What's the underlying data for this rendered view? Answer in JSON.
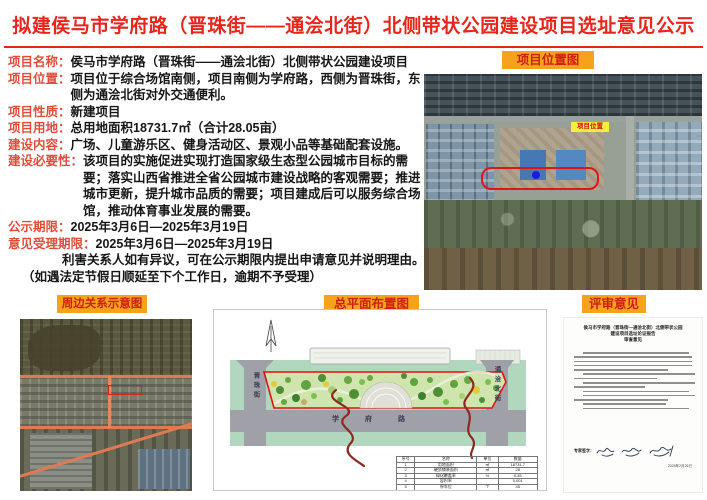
{
  "title": "拟建侯马市学府路（晋珠街——通浍北街）北侧带状公园建设项目选址意见公示",
  "colors": {
    "title_red": "#e8251a",
    "label_red": "#e04e3a",
    "header_orange": "#f6a21d",
    "header_text_red": "#cf1f0e",
    "site_outline_red": "#e01616",
    "site_marker_blue": "#1a1ae0",
    "road_orange": "#e07a52"
  },
  "info": {
    "rows": [
      {
        "label": "项目名称：",
        "text": "侯马市学府路（晋珠街——通浍北街）北侧带状公园建设项目"
      },
      {
        "label": "项目位置：",
        "text": "项目位于综合场馆南侧，项目南侧为学府路，西侧为晋珠街，东侧为通浍北街对外交通便利。"
      },
      {
        "label": "项目性质：",
        "text": "新建项目"
      },
      {
        "label": "项目用地：",
        "text": "总用地面积18731.7㎡（合计28.05亩）"
      },
      {
        "label": "建设内容：",
        "text": "广场、儿童游乐区、健身活动区、景观小品等基础配套设施。"
      },
      {
        "label": "建设必要性：",
        "text": "该项目的实施促进实现打造国家级生态型公园城市目标的需要；落实山西省推进全省公园城市建设战略的客观需要；推进城市更新，提升城市品质的需要；项目建成后可以服务综合场馆，推动体育事业发展的需要。"
      },
      {
        "label": "公示期限：",
        "text": "2025年3月6日—2025年3月19日"
      },
      {
        "label": "意见受理期限：",
        "text": "2025年3月6日—2025年3月19日"
      }
    ],
    "note1": "利害关系人如有异议，可在公示期限内提出申请意见并说明理由。",
    "note2": "（如遇法定节假日顺延至下个工作日，逾期不予受理）"
  },
  "panels": {
    "location": {
      "header": "项目位置图",
      "marker_label": "项目位置"
    },
    "surroundings": {
      "header": "周边关系示意图"
    },
    "siteplan": {
      "header": "总平面布置图",
      "road_left": "晋珠街",
      "road_right": "通浍北街",
      "road_bottom": "学府路",
      "table": {
        "headers": [
          "序号",
          "名称",
          "单位",
          "数量"
        ],
        "rows": [
          [
            "1",
            "用地面积",
            "㎡",
            "18731.7"
          ],
          [
            "2",
            "硬质铺装面积",
            "㎡",
            "28"
          ],
          [
            "3",
            "绿化覆盖率",
            "%",
            "0.35"
          ],
          [
            "4",
            "容积率",
            "",
            "0.001"
          ],
          [
            "5",
            "停车位",
            "个",
            "45"
          ]
        ]
      }
    },
    "review": {
      "header": "评审意见",
      "doc_title1": "侯马市学府路（晋珠街—通浍北街）北侧带状公园",
      "doc_title2": "建设项目选址论证报告",
      "doc_title3": "审查意见",
      "sign_label": "专家签字：",
      "date": "2025年2月26日"
    }
  }
}
